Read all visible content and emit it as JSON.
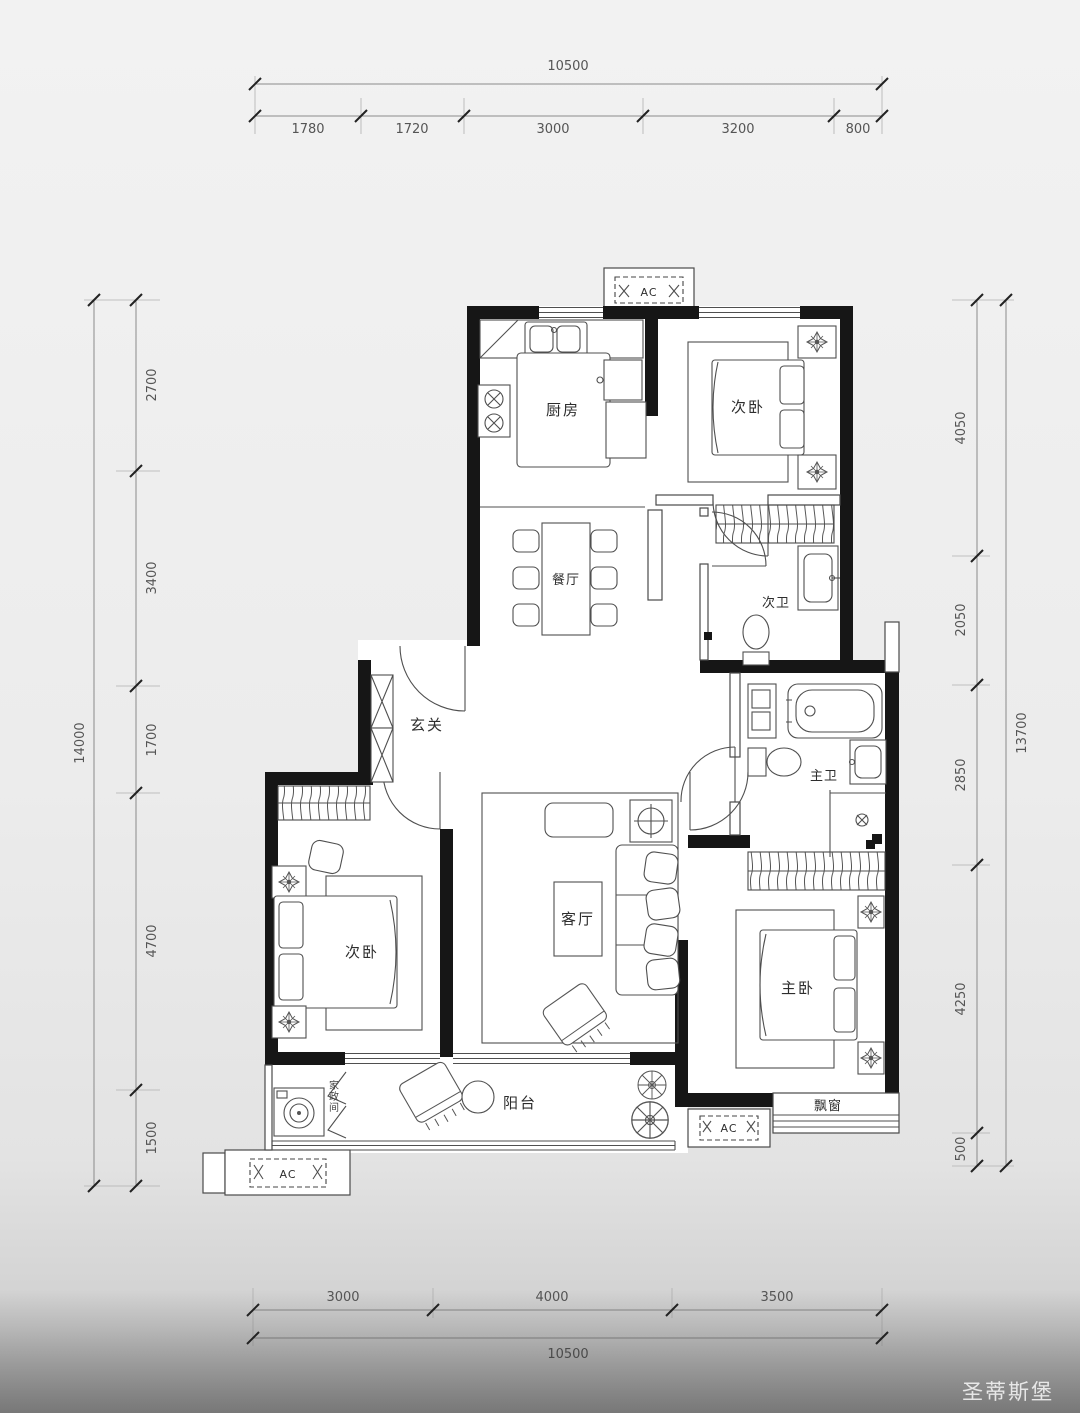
{
  "plan": {
    "rooms": {
      "kitchen": "厨房",
      "bedroom_top": "次卧",
      "dining": "餐厅",
      "bath_secondary": "次卫",
      "entry": "玄关",
      "bedroom_left": "次卧",
      "living": "客厅",
      "bath_master": "主卫",
      "bedroom_master": "主卧",
      "balcony": "阳台",
      "bay_window": "飘窗",
      "utility": "家政间"
    },
    "ac_label": "AC"
  },
  "dimensions": {
    "top": {
      "total": "10500",
      "segments": [
        "1780",
        "1720",
        "3000",
        "3200",
        "800"
      ]
    },
    "bottom": {
      "total": "10500",
      "segments": [
        "3000",
        "4000",
        "3500"
      ]
    },
    "left": {
      "total": "14000",
      "segments": [
        "2700",
        "3400",
        "1700",
        "4700",
        "1500"
      ]
    },
    "right": {
      "total": "13700",
      "segments": [
        "4050",
        "2050",
        "2850",
        "4250",
        "500"
      ]
    }
  },
  "watermark": "圣蒂斯堡"
}
